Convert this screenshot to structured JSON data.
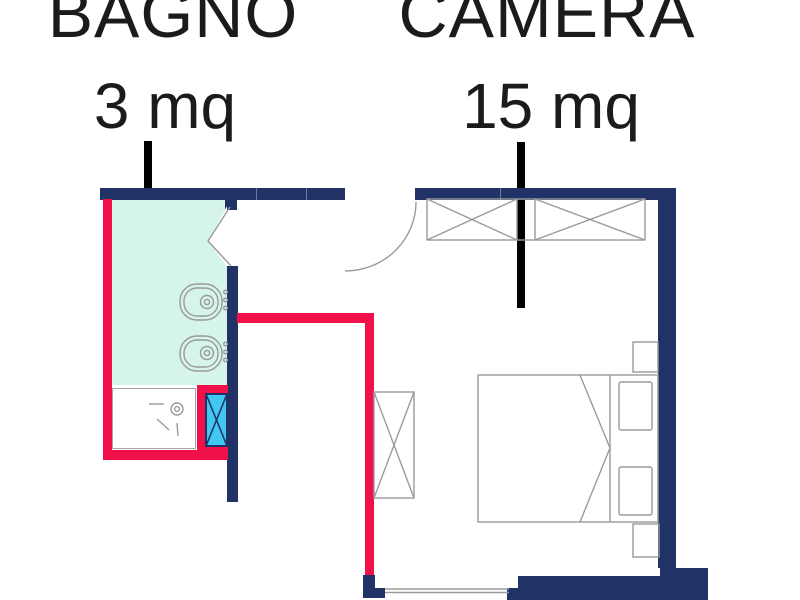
{
  "plan": {
    "type": "floor-plan",
    "rooms": [
      {
        "name": "BAGNO",
        "area": "3 mq"
      },
      {
        "name": "CAMERA",
        "area": "15 mq"
      }
    ]
  },
  "colors": {
    "wall-navy": "#213266",
    "wall-red": "#f0104a",
    "bathroom-floor": "#d5f4ea",
    "glass-cyan": "#40c8f0",
    "furniture-line": "#9a9a9a",
    "label-text": "#1b1b1b",
    "pointer-black": "#000000"
  }
}
